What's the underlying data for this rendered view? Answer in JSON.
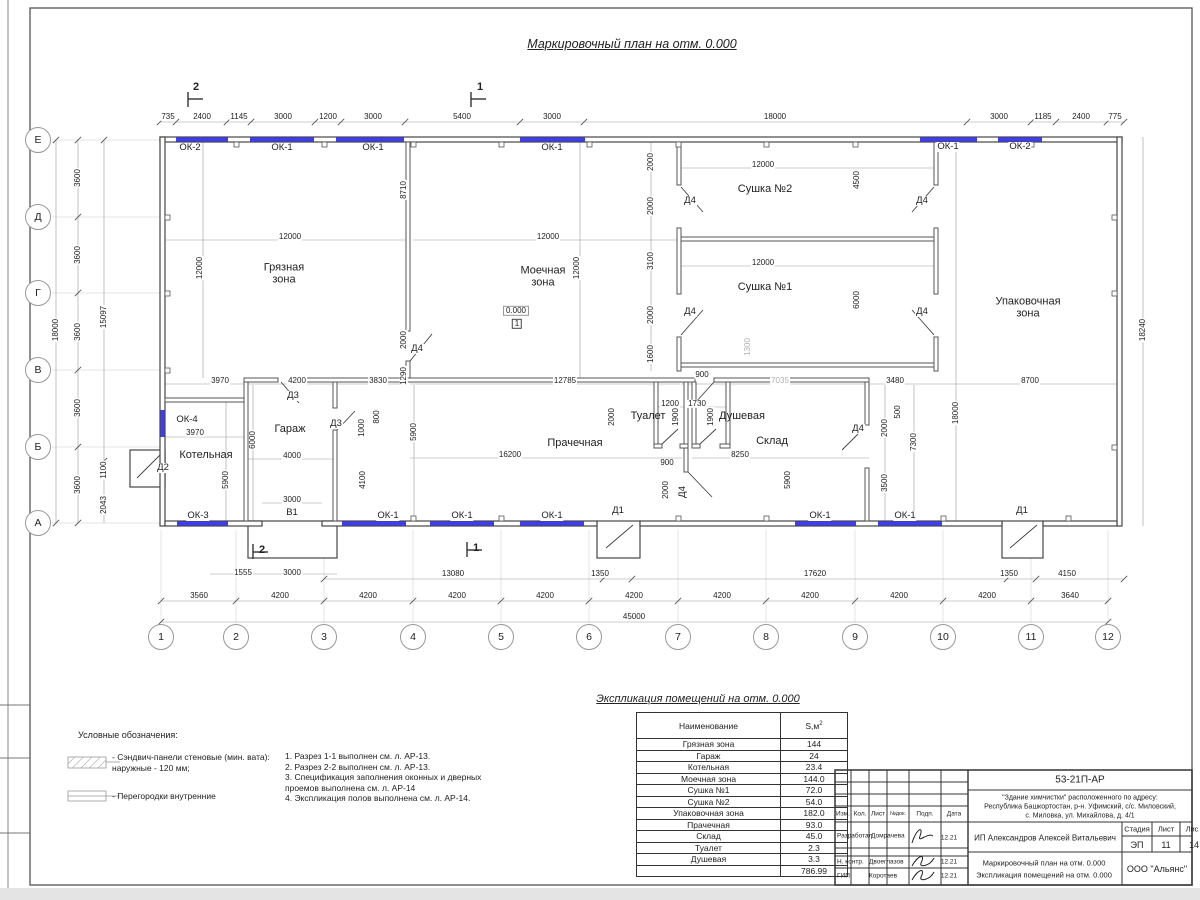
{
  "sheet": {
    "plan_title": "Маркировочный план на отм. 0.000",
    "expl_title": "Экспликация помещений на отм. 0.000"
  },
  "legend": {
    "title": "Условные обозначения:",
    "item1": "- Сэндвич-панели стеновые (мин. вата):\nнаружные - 120 мм;",
    "item2": "- Перегородки внутренние"
  },
  "notes": "1. Разрез 1-1 выполнен см. л. АР-13.\n2. Разрез 2-2 выполнен см. л. АР-13.\n3. Спецификация заполнения оконных и дверных\nпроемов выполнена см. л. АР-14\n4. Экспликация полов выполнена см. л. АР-14.",
  "explication": {
    "col_name": "Наименование",
    "col_area": "S,м",
    "col_area_sup": "2",
    "rows": [
      [
        "Грязная зона",
        "144"
      ],
      [
        "Гараж",
        "24"
      ],
      [
        "Котельная",
        "23.4"
      ],
      [
        "Моечная зона",
        "144.0"
      ],
      [
        "Сушка №1",
        "72.0"
      ],
      [
        "Сушка №2",
        "54.0"
      ],
      [
        "Упаковочная зона",
        "182.0"
      ],
      [
        "Прачечная",
        "93.0"
      ],
      [
        "Склад",
        "45.0"
      ],
      [
        "Туалет",
        "2.3"
      ],
      [
        "Душевая",
        "3.3"
      ],
      [
        "",
        "786.99"
      ]
    ]
  },
  "title_block": {
    "code": "53-21П-АР",
    "addr1": "\"Здание химчистки\" расположенного по адресу:",
    "addr2": "Республика Башкортостан, р-н. Уфимский, с/с. Миловский,",
    "addr3": "с. Миловка, ул. Михайлова, д. 4/1",
    "col_izm": "Изм.",
    "col_kol": "Кол.",
    "col_list": "Лист",
    "col_ndok": "№док.",
    "col_podp": "Подп.",
    "col_data": "Дата",
    "role1": "Разработал",
    "name1": "Домрачева",
    "date1": "12.21",
    "person": "ИП Александров Алексей Витальевич",
    "stage_h": "Стадия",
    "list_h": "Лист",
    "listov_h": "Лис",
    "stage_v": "ЭП",
    "list_v": "11",
    "listov_v": "14",
    "role2": "Н. контр.",
    "name2": "Двоеглазов",
    "date2": "12.21",
    "role3": "ГИП",
    "name3": "Коротаев",
    "date3": "12.21",
    "doc1": "Маркировочный план на отм. 0.000",
    "doc2": "Экспликация помещений на отм. 0.000",
    "org": "ООО \"Альянс\""
  },
  "axes": {
    "cols": [
      "1",
      "2",
      "3",
      "4",
      "5",
      "6",
      "7",
      "8",
      "9",
      "10",
      "11",
      "12"
    ],
    "col_xs": [
      161,
      236,
      324,
      413,
      501,
      589,
      678,
      766,
      855,
      943,
      1031,
      1108
    ],
    "col_y": 637,
    "rows": [
      "Е",
      "Д",
      "Г",
      "В",
      "Б",
      "А"
    ],
    "row_ys": [
      140,
      217,
      293,
      370,
      447,
      523
    ],
    "row_x": 38
  },
  "colors": {
    "window": "#3d3df2",
    "wall": "#454545",
    "dim": "#222222",
    "ref_dim": "#b0b0b0"
  },
  "labels": [
    {
      "x": 168,
      "y": 117,
      "t": "735",
      "c": "d"
    },
    {
      "x": 202,
      "y": 117,
      "t": "2400",
      "c": "d"
    },
    {
      "x": 239,
      "y": 117,
      "t": "1145",
      "c": "d"
    },
    {
      "x": 283,
      "y": 117,
      "t": "3000",
      "c": "d"
    },
    {
      "x": 328,
      "y": 117,
      "t": "1200",
      "c": "d"
    },
    {
      "x": 373,
      "y": 117,
      "t": "3000",
      "c": "d"
    },
    {
      "x": 462,
      "y": 117,
      "t": "5400",
      "c": "d"
    },
    {
      "x": 552,
      "y": 117,
      "t": "3000",
      "c": "d"
    },
    {
      "x": 775,
      "y": 117,
      "t": "18000",
      "c": "d"
    },
    {
      "x": 999,
      "y": 117,
      "t": "3000",
      "c": "d"
    },
    {
      "x": 1043,
      "y": 117,
      "t": "1185",
      "c": "d"
    },
    {
      "x": 1081,
      "y": 117,
      "t": "2400",
      "c": "d"
    },
    {
      "x": 1115,
      "y": 117,
      "t": "775",
      "c": "d"
    },
    {
      "x": 190,
      "y": 148,
      "t": "ОК-2",
      "c": "wn"
    },
    {
      "x": 282,
      "y": 148,
      "t": "ОК-1",
      "c": "wn"
    },
    {
      "x": 373,
      "y": 148,
      "t": "ОК-1",
      "c": "wn"
    },
    {
      "x": 552,
      "y": 148,
      "t": "ОК-1",
      "c": "wn"
    },
    {
      "x": 948,
      "y": 147,
      "t": "ОК-1",
      "c": "wn"
    },
    {
      "x": 1020,
      "y": 147,
      "t": "ОК-2",
      "c": "wn"
    },
    {
      "x": 196,
      "y": 88,
      "t": "2",
      "c": "sc"
    },
    {
      "x": 480,
      "y": 88,
      "t": "1",
      "c": "sc"
    },
    {
      "x": 262,
      "y": 551,
      "t": "2",
      "c": "sc"
    },
    {
      "x": 476,
      "y": 549,
      "t": "1",
      "c": "sc"
    },
    {
      "x": 56,
      "y": 330,
      "t": "18000",
      "c": "dv"
    },
    {
      "x": 78,
      "y": 178,
      "t": "3600",
      "c": "dv"
    },
    {
      "x": 78,
      "y": 255,
      "t": "3600",
      "c": "dv"
    },
    {
      "x": 78,
      "y": 332,
      "t": "3600",
      "c": "dv"
    },
    {
      "x": 78,
      "y": 408,
      "t": "3600",
      "c": "dv"
    },
    {
      "x": 78,
      "y": 485,
      "t": "3600",
      "c": "dv"
    },
    {
      "x": 104,
      "y": 317,
      "t": "15097",
      "c": "dv"
    },
    {
      "x": 104,
      "y": 470,
      "t": "1100",
      "c": "dv"
    },
    {
      "x": 104,
      "y": 505,
      "t": "2043",
      "c": "dv"
    },
    {
      "x": 284,
      "y": 274,
      "t": "Грязная\nзона",
      "c": "rm"
    },
    {
      "x": 543,
      "y": 277,
      "t": "Моечная\nзона",
      "c": "rm"
    },
    {
      "x": 765,
      "y": 190,
      "t": "Сушка №2",
      "c": "rm"
    },
    {
      "x": 765,
      "y": 288,
      "t": "Сушка №1",
      "c": "rm"
    },
    {
      "x": 1028,
      "y": 308,
      "t": "Упаковочная\nзона",
      "c": "rm"
    },
    {
      "x": 206,
      "y": 456,
      "t": "Котельная",
      "c": "rm"
    },
    {
      "x": 290,
      "y": 430,
      "t": "Гараж",
      "c": "rm"
    },
    {
      "x": 575,
      "y": 444,
      "t": "Прачечная",
      "c": "rm"
    },
    {
      "x": 648,
      "y": 417,
      "t": "Туалет",
      "c": "rm"
    },
    {
      "x": 742,
      "y": 417,
      "t": "Душевая",
      "c": "rm"
    },
    {
      "x": 772,
      "y": 442,
      "t": "Склад",
      "c": "rm"
    },
    {
      "x": 290,
      "y": 237,
      "t": "12000",
      "c": "d"
    },
    {
      "x": 200,
      "y": 268,
      "t": "12000",
      "c": "dv"
    },
    {
      "x": 548,
      "y": 237,
      "t": "12000",
      "c": "d"
    },
    {
      "x": 577,
      "y": 268,
      "t": "12000",
      "c": "dv"
    },
    {
      "x": 404,
      "y": 190,
      "t": "8710",
      "c": "dv"
    },
    {
      "x": 763,
      "y": 165,
      "t": "12000",
      "c": "d"
    },
    {
      "x": 857,
      "y": 180,
      "t": "4500",
      "c": "dv"
    },
    {
      "x": 763,
      "y": 263,
      "t": "12000",
      "c": "d"
    },
    {
      "x": 857,
      "y": 300,
      "t": "6000",
      "c": "dv"
    },
    {
      "x": 651,
      "y": 162,
      "t": "2000",
      "c": "dv"
    },
    {
      "x": 651,
      "y": 206,
      "t": "2000",
      "c": "dv"
    },
    {
      "x": 651,
      "y": 261,
      "t": "3100",
      "c": "dv"
    },
    {
      "x": 651,
      "y": 315,
      "t": "2000",
      "c": "dv"
    },
    {
      "x": 651,
      "y": 354,
      "t": "1600",
      "c": "dv"
    },
    {
      "x": 690,
      "y": 201,
      "t": "Д4",
      "c": "dr"
    },
    {
      "x": 922,
      "y": 201,
      "t": "Д4",
      "c": "dr"
    },
    {
      "x": 690,
      "y": 312,
      "t": "Д4",
      "c": "dr"
    },
    {
      "x": 922,
      "y": 312,
      "t": "Д4",
      "c": "dr"
    },
    {
      "x": 417,
      "y": 349,
      "t": "Д4",
      "c": "dr"
    },
    {
      "x": 404,
      "y": 340,
      "t": "2000",
      "c": "dv"
    },
    {
      "x": 404,
      "y": 376,
      "t": "1290",
      "c": "dv"
    },
    {
      "x": 516,
      "y": 311,
      "t": "0.000",
      "c": "lvl"
    },
    {
      "x": 517,
      "y": 324,
      "t": "1",
      "c": "lvb"
    },
    {
      "x": 748,
      "y": 347,
      "t": "1300",
      "c": "dgv"
    },
    {
      "x": 780,
      "y": 381,
      "t": "7035",
      "c": "dg"
    },
    {
      "x": 220,
      "y": 381,
      "t": "3970",
      "c": "d"
    },
    {
      "x": 297,
      "y": 381,
      "t": "4200",
      "c": "d"
    },
    {
      "x": 378,
      "y": 381,
      "t": "3830",
      "c": "d"
    },
    {
      "x": 565,
      "y": 381,
      "t": "12785",
      "c": "d"
    },
    {
      "x": 702,
      "y": 375,
      "t": "900",
      "c": "d"
    },
    {
      "x": 895,
      "y": 381,
      "t": "3480",
      "c": "d"
    },
    {
      "x": 1030,
      "y": 381,
      "t": "8700",
      "c": "d"
    },
    {
      "x": 670,
      "y": 404,
      "t": "1200",
      "c": "d"
    },
    {
      "x": 697,
      "y": 404,
      "t": "1730",
      "c": "d"
    },
    {
      "x": 612,
      "y": 417,
      "t": "2000",
      "c": "dv"
    },
    {
      "x": 676,
      "y": 417,
      "t": "1900",
      "c": "dv"
    },
    {
      "x": 711,
      "y": 417,
      "t": "1900",
      "c": "dv"
    },
    {
      "x": 667,
      "y": 463,
      "t": "900",
      "c": "d"
    },
    {
      "x": 666,
      "y": 490,
      "t": "2000",
      "c": "dv"
    },
    {
      "x": 683,
      "y": 492,
      "t": "Д4",
      "c": "drv"
    },
    {
      "x": 510,
      "y": 455,
      "t": "16200",
      "c": "d"
    },
    {
      "x": 740,
      "y": 455,
      "t": "8250",
      "c": "d"
    },
    {
      "x": 788,
      "y": 480,
      "t": "5900",
      "c": "dv"
    },
    {
      "x": 898,
      "y": 412,
      "t": "500",
      "c": "dv"
    },
    {
      "x": 885,
      "y": 428,
      "t": "2000",
      "c": "dv"
    },
    {
      "x": 885,
      "y": 483,
      "t": "3500",
      "c": "dv"
    },
    {
      "x": 914,
      "y": 442,
      "t": "7300",
      "c": "dv"
    },
    {
      "x": 956,
      "y": 413,
      "t": "18000",
      "c": "dv"
    },
    {
      "x": 1143,
      "y": 330,
      "t": "18240",
      "c": "dv"
    },
    {
      "x": 858,
      "y": 429,
      "t": "Д4",
      "c": "dr"
    },
    {
      "x": 187,
      "y": 420,
      "t": "ОК-4",
      "c": "wn"
    },
    {
      "x": 195,
      "y": 433,
      "t": "3970",
      "c": "d"
    },
    {
      "x": 163,
      "y": 468,
      "t": "Д2",
      "c": "dr"
    },
    {
      "x": 293,
      "y": 396,
      "t": "Д3",
      "c": "dr"
    },
    {
      "x": 336,
      "y": 424,
      "t": "Д3",
      "c": "dr"
    },
    {
      "x": 253,
      "y": 440,
      "t": "6000",
      "c": "dv"
    },
    {
      "x": 226,
      "y": 480,
      "t": "5900",
      "c": "dv"
    },
    {
      "x": 362,
      "y": 428,
      "t": "1000",
      "c": "dv"
    },
    {
      "x": 377,
      "y": 417,
      "t": "800",
      "c": "dv"
    },
    {
      "x": 414,
      "y": 432,
      "t": "5900",
      "c": "dv"
    },
    {
      "x": 292,
      "y": 456,
      "t": "4000",
      "c": "d"
    },
    {
      "x": 363,
      "y": 480,
      "t": "4100",
      "c": "dv"
    },
    {
      "x": 292,
      "y": 500,
      "t": "3000",
      "c": "d"
    },
    {
      "x": 292,
      "y": 513,
      "t": "В1",
      "c": "dr"
    },
    {
      "x": 198,
      "y": 516,
      "t": "ОК-3",
      "c": "wn"
    },
    {
      "x": 388,
      "y": 516,
      "t": "ОК-1",
      "c": "wn"
    },
    {
      "x": 462,
      "y": 516,
      "t": "ОК-1",
      "c": "wn"
    },
    {
      "x": 552,
      "y": 516,
      "t": "ОК-1",
      "c": "wn"
    },
    {
      "x": 820,
      "y": 516,
      "t": "ОК-1",
      "c": "wn"
    },
    {
      "x": 905,
      "y": 516,
      "t": "ОК-1",
      "c": "wn"
    },
    {
      "x": 618,
      "y": 511,
      "t": "Д1",
      "c": "dr"
    },
    {
      "x": 1022,
      "y": 511,
      "t": "Д1",
      "c": "dr"
    },
    {
      "x": 243,
      "y": 573,
      "t": "1555",
      "c": "d"
    },
    {
      "x": 292,
      "y": 573,
      "t": "3000",
      "c": "d"
    },
    {
      "x": 453,
      "y": 574,
      "t": "13080",
      "c": "d"
    },
    {
      "x": 600,
      "y": 574,
      "t": "1350",
      "c": "d"
    },
    {
      "x": 815,
      "y": 574,
      "t": "17620",
      "c": "d"
    },
    {
      "x": 1009,
      "y": 574,
      "t": "1350",
      "c": "d"
    },
    {
      "x": 1067,
      "y": 574,
      "t": "4150",
      "c": "d"
    },
    {
      "x": 199,
      "y": 596,
      "t": "3560",
      "c": "d"
    },
    {
      "x": 280,
      "y": 596,
      "t": "4200",
      "c": "d"
    },
    {
      "x": 368,
      "y": 596,
      "t": "4200",
      "c": "d"
    },
    {
      "x": 457,
      "y": 596,
      "t": "4200",
      "c": "d"
    },
    {
      "x": 545,
      "y": 596,
      "t": "4200",
      "c": "d"
    },
    {
      "x": 634,
      "y": 596,
      "t": "4200",
      "c": "d"
    },
    {
      "x": 722,
      "y": 596,
      "t": "4200",
      "c": "d"
    },
    {
      "x": 810,
      "y": 596,
      "t": "4200",
      "c": "d"
    },
    {
      "x": 899,
      "y": 596,
      "t": "4200",
      "c": "d"
    },
    {
      "x": 987,
      "y": 596,
      "t": "4200",
      "c": "d"
    },
    {
      "x": 1070,
      "y": 596,
      "t": "3640",
      "c": "d"
    },
    {
      "x": 634,
      "y": 617,
      "t": "45000",
      "c": "d"
    }
  ]
}
